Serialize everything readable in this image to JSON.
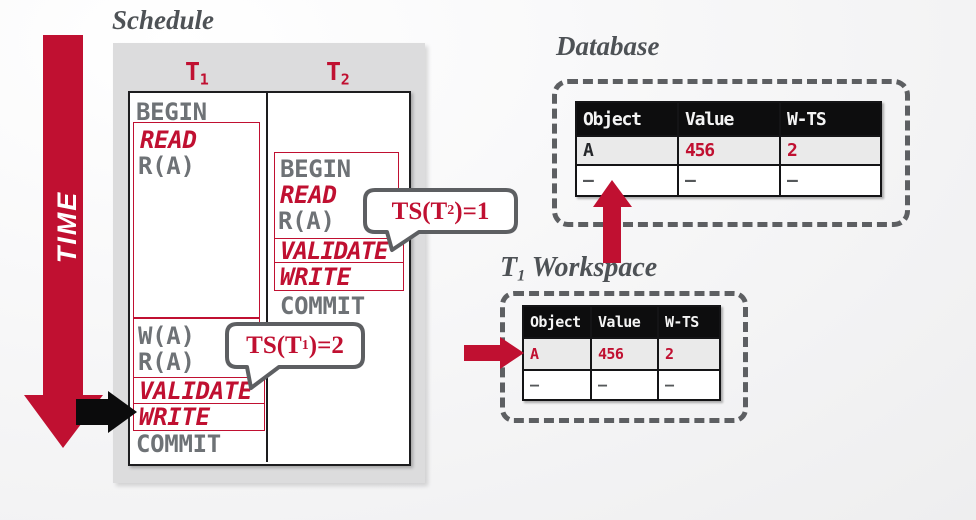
{
  "colors": {
    "accent_red": "#c01031",
    "title_gray": "#4e5256",
    "mono_gray": "#6e7276",
    "panel_gray": "#dcdcdd",
    "highlight_row_gray": "#eaeaea",
    "bubble_border_gray": "#5d5f62",
    "table_header_black": "#0d0d0e"
  },
  "schedule": {
    "title": "Schedule",
    "time_label": "TIME",
    "t1": {
      "header": "T",
      "header_sub": "1",
      "ops": {
        "begin": "BEGIN",
        "read": "READ",
        "r1": "R(A)",
        "w1": "W(A)",
        "r2": "R(A)",
        "validate": "VALIDATE",
        "write": "WRITE",
        "commit": "COMMIT"
      }
    },
    "t2": {
      "header": "T",
      "header_sub": "2",
      "ops": {
        "begin": "BEGIN",
        "read": "READ",
        "r1": "R(A)",
        "validate": "VALIDATE",
        "write": "WRITE",
        "commit": "COMMIT"
      }
    }
  },
  "callouts": {
    "ts_t2": {
      "prefix": "TS(T",
      "sub": "2",
      "suffix": ")=1"
    },
    "ts_t1": {
      "prefix": "TS(T",
      "sub": "1",
      "suffix": ")=2"
    }
  },
  "database": {
    "title": "Database",
    "headers": [
      "Object",
      "Value",
      "W-TS"
    ],
    "rows": [
      [
        "A",
        "456",
        "2"
      ],
      [
        "–",
        "–",
        "–"
      ]
    ]
  },
  "workspace": {
    "title_prefix": "T",
    "title_sub": "1",
    "title_suffix": " Workspace",
    "headers": [
      "Object",
      "Value",
      "W-TS"
    ],
    "rows": [
      [
        "A",
        "456",
        "2"
      ],
      [
        "–",
        "–",
        "–"
      ]
    ]
  }
}
